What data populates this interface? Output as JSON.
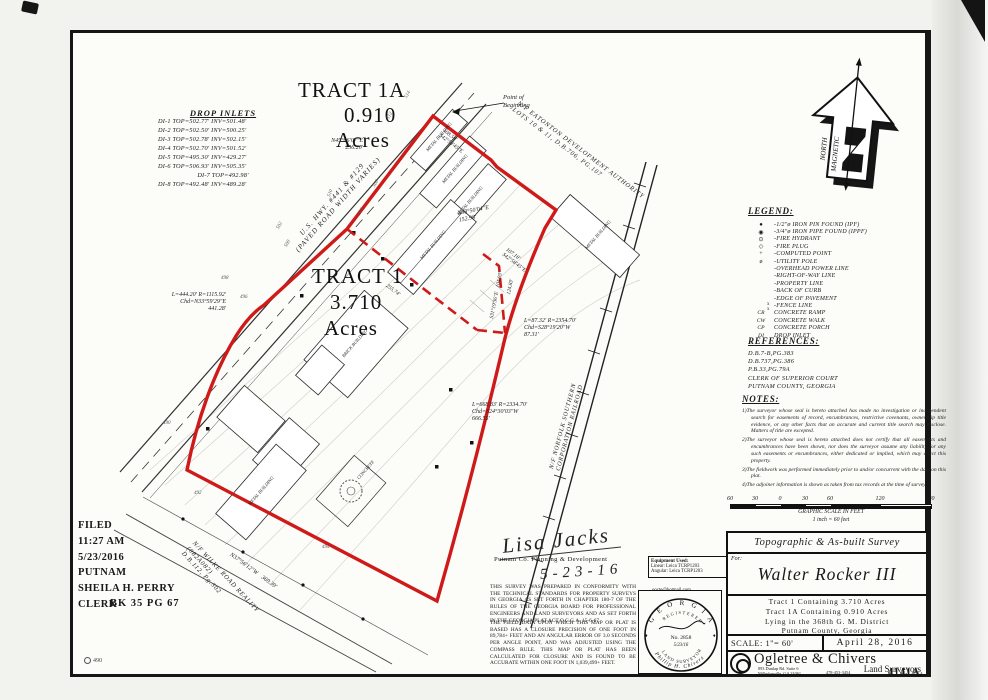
{
  "sheet": {
    "number_stamp": "4141A",
    "corner_stamp": "490"
  },
  "drop_inlets": {
    "title": "DROP INLETS",
    "rows": [
      "DI-1 TOP=502.77'  INV=501.48'",
      "DI-2 TOP=502.50'  INV=500.25'",
      "DI-3 TOP=502.78'  INV=502.15'",
      "DI-4 TOP=502.70'  INV=501.52'",
      "DI-5 TOP=495.30'  INV=429.27'",
      "DI-6 TOP=506.93'  INV=505.35'",
      "DI-7 TOP=492.98'",
      "DI-8 TOP=492.48'  INV=489.28'"
    ]
  },
  "tract1a": {
    "name": "TRACT 1A",
    "area": "0.910",
    "unit": "Acres"
  },
  "tract1": {
    "name": "TRACT 1",
    "area": "3.710",
    "unit": "Acres"
  },
  "map": {
    "pob1": "Point of",
    "pob2": "Beginning",
    "hwy1": "U.S. HWY. #441 & #129",
    "hwy2": "(PAVED ROAD WIDTH VARIES)",
    "eatonton1": "N/F EATONTON DEVELOPMENT AUTHORITY",
    "eatonton2": "LOTS 10 & 11, D.B.706, PG.107",
    "norfolk1": "N/F NORFOLK SOUTHERN",
    "norfolk2": "CORPORATION RAILROAD",
    "wilke1": "N/F WILKE ROAD REALITY",
    "wilke2": "(082A082)",
    "wilke3": "D.B.112, Pg.302",
    "brg_hwy_1a": "N45°06'07\"E",
    "brg_hwy_1a_d": "256.20'",
    "brg_hwy_1": "N38°50'04\"E",
    "brg_hwy_1_d": "152.98'",
    "brg_ne1_d": "108.54'",
    "brg_ne1": "S42°58'45\"E",
    "brg_ne2_d": "107.18'",
    "brg_ne2": "S42°58'45\"E",
    "curve1a": "L=444.20' R=1115.92'",
    "curve1b": "Chd=N33°59'29\"E",
    "curve1c": "441.28'",
    "curve2a": "L=87.32' R=2354.70'",
    "curve2b": "Chd=S28°19'20\"W",
    "curve2c": "87.31'",
    "curve3a": "L=668.83' R=2334.70'",
    "curve3b": "Chd=S24°30'03\"W",
    "curve3c": "666.55'",
    "brg_sw": "N37°56'12\"W",
    "brg_sw_d": "369.39'",
    "div_d": "255.74'",
    "brg_int": "S31°19'36\"E",
    "brg_int_d": "104.93'",
    "brg_int2_d": "124.83'",
    "metal_building": "METAL BUILDING",
    "brick_building": "BRICK BUILDING",
    "concrete": "CONCRETE",
    "contours": [
      "490",
      "492",
      "494",
      "496",
      "498",
      "500",
      "502",
      "504",
      "506",
      "508",
      "510",
      "512",
      "514"
    ]
  },
  "north_arrow": {
    "line1": "MAGNETIC",
    "line2": "NORTH"
  },
  "legend": {
    "title": "LEGEND:",
    "items": [
      {
        "sym": "●",
        "label": "-1/2\"ø IRON PIN FOUND (IPF)"
      },
      {
        "sym": "◉",
        "label": "-3/4\"ø IRON PIPE FOUND (IPPF)"
      },
      {
        "sym": "⊙",
        "label": "-FIRE HYDRANT"
      },
      {
        "sym": "◇",
        "label": "-FIRE PLUG"
      },
      {
        "sym": "+",
        "label": "-COMPUTED POINT"
      },
      {
        "sym": "ø",
        "label": "-UTILITY POLE"
      },
      {
        "sym": "",
        "label": "-OVERHEAD POWER LINE"
      },
      {
        "sym": "",
        "label": "-RIGHT-OF-WAY LINE"
      },
      {
        "sym": "",
        "label": "-PROPERTY LINE"
      },
      {
        "sym": "",
        "label": "-BACK OF CURB"
      },
      {
        "sym": "",
        "label": "-EDGE OF PAVEMENT"
      },
      {
        "sym": "",
        "label": "-FENCE LINE"
      },
      {
        "sym": "CR",
        "label": "CONCRETE RAMP"
      },
      {
        "sym": "CW",
        "label": "CONCRETE WALK"
      },
      {
        "sym": "CP",
        "label": "CONCRETE PORCH"
      },
      {
        "sym": "DI",
        "label": "DROP INLET"
      }
    ]
  },
  "references": {
    "title": "REFERENCES:",
    "lines": [
      "D.B.7-B,PG.383",
      "D.B.737,PG.386",
      "P.B.33,PG.79A",
      "CLERK OF SUPERIOR COURT",
      "PUTNAM COUNTY, GEORGIA"
    ]
  },
  "notes": {
    "title": "NOTES:",
    "items": [
      "1)The surveyor whose seal is hereto attached has made no investigation or independent search for easements of record, encumbrances, restrictive covenants, ownership title evidence, or any other facts that an accurate and current title search may disclose. Matters of title are excepted.",
      "2)The surveyor whose seal is hereto attached does not certify that all easements and encumbrances have been shown, nor does the surveyor assume any liability for any such easements or encumbrances, either dedicated or implied, which may affect this property.",
      "3)The fieldwork was performed immediately prior to and/or concurrent with the date on this plat.",
      "4)The adjoiner information is shown as taken from tax records at the time of survey."
    ]
  },
  "scalebar": {
    "ticks": [
      "60",
      "30",
      "0",
      "30",
      "60",
      "120",
      "180"
    ],
    "caption1": "GRAPHIC SCALE IN FEET",
    "caption2": "1 inch = 60 feet"
  },
  "filed": {
    "line1": "FILED",
    "line2": "11:27 AM",
    "line3": "5/23/2016",
    "line4": "PUTNAM",
    "line5": "SHEILA H. PERRY",
    "line6": "CLERK",
    "book": "BK 35   PG 67"
  },
  "approval": {
    "signature": "Lisa Jacks",
    "agency": "Putnam Co. Planning & Development",
    "date": "5-23-16"
  },
  "certification": {
    "para1": "THIS SURVEY WAS PREPARED IN CONFORMITY WITH THE TECHNICAL STANDARDS FOR PROPERTY SURVEYS IN GEORGIA AS SET FORTH IN CHAPTER 180-7 OF THE RULES OF THE GEORGIA BOARD FOR PROFESSIONAL ENGINEERS AND LAND SURVEYORS AND AS SET FORTH IN THE GEORGIA PLAT ACT O.C.G.A. 15-6-67.",
    "para2": "THE FIELD DATA UPON WHICH THIS MAP OR PLAT IS BASED HAS A CLOSURE PRECISION OF ONE FOOT IN 89,784+ FEET AND AN ANGULAR ERROR OF 3.0 SECONDS PER ANGLE POINT, AND WAS ADJUSTED USING THE COMPASS RULE. THIS MAP OR PLAT HAS BEEN CALCULATED FOR CLOSURE AND IS FOUND TO BE ACCURATE WITHIN ONE FOOT IN 1,039,499+ FEET."
  },
  "equipment": {
    "title": "Equipment Used:",
    "linear": "Linear: Leica TCRP1203",
    "angular": "Angular: Leica TCRP1203",
    "email": "oocte@hotmail.com"
  },
  "seal": {
    "top": "G E O R G I A",
    "registered": "REGISTERED",
    "no": "No. 2858",
    "bottom": "LAND SURVEYOR",
    "name": "Phillip H. Chivers",
    "date": "5/23/16"
  },
  "titleblock": {
    "survey_type": "Topographic & As-built Survey",
    "for_label": "For:",
    "client": "Walter Rocker III",
    "desc1": "Tract 1 Containing 3.710 Acres",
    "desc2": "Tract 1A Containing 0.910 Acres",
    "desc3": "Lying in the 368th G. M. District",
    "desc4": "Putnam County, Georgia",
    "scale_label": "SCALE: 1\"= 60'",
    "date": "April 28, 2016",
    "firm_name": "Ogletree & Chivers",
    "firm_type": "Land Surveyors",
    "address1": "893 Dunlap Rd. Suite 6",
    "address2": "Milledgeville, GA 31061",
    "phone": "478-453-3454",
    "job_small": "4141A"
  }
}
